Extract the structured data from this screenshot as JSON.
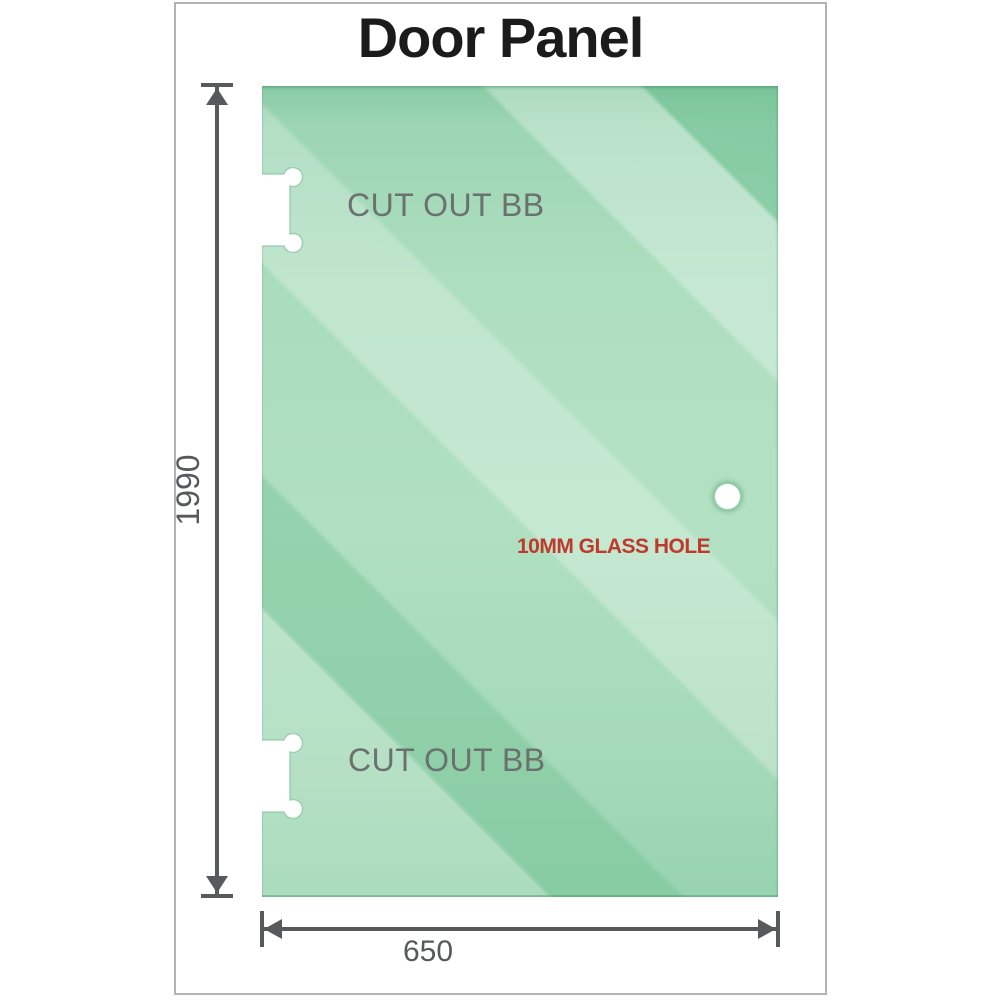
{
  "title": "Door Panel",
  "glass": {
    "cutout_top_label": "CUT OUT BB",
    "cutout_bottom_label": "CUT OUT BB",
    "hole_label": "10MM GLASS HOLE"
  },
  "dimensions": {
    "height_value": "1990",
    "width_value": "650"
  },
  "colors": {
    "glass_green": "#9ed7b5",
    "glass_dark_green": "#7dc69d",
    "cutout_white": "#ffffff",
    "cutout_edge_green": "#7fbf9f",
    "dimension_gray": "#57595a",
    "label_gray": "#6b716e",
    "hole_label_red": "#bf3a2c",
    "frame_border_gray": "#b1b4b3",
    "title_black": "#1b1b1b"
  }
}
